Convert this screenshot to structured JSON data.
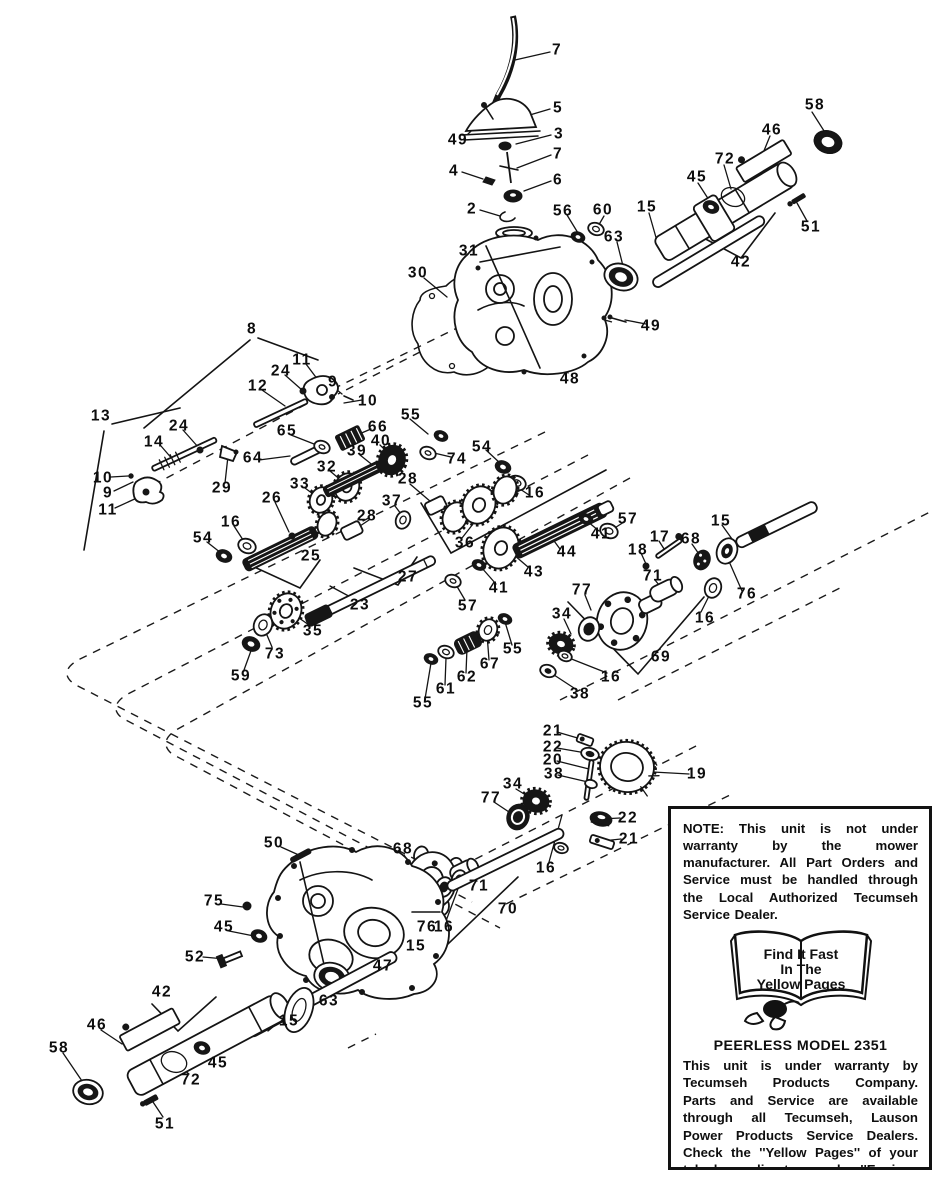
{
  "diagram": {
    "type": "exploded-parts-diagram",
    "product": "PEERLESS MODEL 2351",
    "callouts": [
      {
        "n": "7",
        "x": 557,
        "y": 50
      },
      {
        "n": "5",
        "x": 558,
        "y": 108
      },
      {
        "n": "58",
        "x": 815,
        "y": 105
      },
      {
        "n": "46",
        "x": 772,
        "y": 130
      },
      {
        "n": "3",
        "x": 559,
        "y": 134
      },
      {
        "n": "49",
        "x": 458,
        "y": 140
      },
      {
        "n": "7",
        "x": 558,
        "y": 154
      },
      {
        "n": "72",
        "x": 725,
        "y": 159
      },
      {
        "n": "4",
        "x": 454,
        "y": 171
      },
      {
        "n": "45",
        "x": 697,
        "y": 177
      },
      {
        "n": "6",
        "x": 558,
        "y": 180
      },
      {
        "n": "15",
        "x": 647,
        "y": 207
      },
      {
        "n": "2",
        "x": 472,
        "y": 209
      },
      {
        "n": "56",
        "x": 563,
        "y": 211
      },
      {
        "n": "60",
        "x": 603,
        "y": 210
      },
      {
        "n": "51",
        "x": 811,
        "y": 227
      },
      {
        "n": "63",
        "x": 614,
        "y": 237
      },
      {
        "n": "31",
        "x": 469,
        "y": 251
      },
      {
        "n": "42",
        "x": 741,
        "y": 262
      },
      {
        "n": "30",
        "x": 418,
        "y": 273
      },
      {
        "n": "49",
        "x": 651,
        "y": 326
      },
      {
        "n": "8",
        "x": 252,
        "y": 329
      },
      {
        "n": "11",
        "x": 302,
        "y": 360
      },
      {
        "n": "24",
        "x": 281,
        "y": 371
      },
      {
        "n": "9",
        "x": 333,
        "y": 382
      },
      {
        "n": "12",
        "x": 258,
        "y": 386
      },
      {
        "n": "48",
        "x": 570,
        "y": 379
      },
      {
        "n": "10",
        "x": 368,
        "y": 401
      },
      {
        "n": "13",
        "x": 101,
        "y": 416
      },
      {
        "n": "55",
        "x": 411,
        "y": 415
      },
      {
        "n": "24",
        "x": 179,
        "y": 426
      },
      {
        "n": "66",
        "x": 378,
        "y": 427
      },
      {
        "n": "65",
        "x": 287,
        "y": 431
      },
      {
        "n": "40",
        "x": 381,
        "y": 441
      },
      {
        "n": "14",
        "x": 154,
        "y": 442
      },
      {
        "n": "54",
        "x": 482,
        "y": 447
      },
      {
        "n": "39",
        "x": 357,
        "y": 451
      },
      {
        "n": "64",
        "x": 253,
        "y": 458
      },
      {
        "n": "74",
        "x": 457,
        "y": 459
      },
      {
        "n": "32",
        "x": 327,
        "y": 467
      },
      {
        "n": "10",
        "x": 103,
        "y": 478
      },
      {
        "n": "28",
        "x": 408,
        "y": 479
      },
      {
        "n": "33",
        "x": 300,
        "y": 484
      },
      {
        "n": "29",
        "x": 222,
        "y": 488
      },
      {
        "n": "9",
        "x": 108,
        "y": 493
      },
      {
        "n": "16",
        "x": 535,
        "y": 493
      },
      {
        "n": "26",
        "x": 272,
        "y": 498
      },
      {
        "n": "37",
        "x": 392,
        "y": 501
      },
      {
        "n": "11",
        "x": 108,
        "y": 510
      },
      {
        "n": "28",
        "x": 367,
        "y": 516
      },
      {
        "n": "57",
        "x": 628,
        "y": 519
      },
      {
        "n": "15",
        "x": 721,
        "y": 521
      },
      {
        "n": "16",
        "x": 231,
        "y": 522
      },
      {
        "n": "41",
        "x": 601,
        "y": 534
      },
      {
        "n": "17",
        "x": 660,
        "y": 537
      },
      {
        "n": "54",
        "x": 203,
        "y": 538
      },
      {
        "n": "68",
        "x": 691,
        "y": 539
      },
      {
        "n": "36",
        "x": 465,
        "y": 543
      },
      {
        "n": "18",
        "x": 638,
        "y": 550
      },
      {
        "n": "44",
        "x": 567,
        "y": 552
      },
      {
        "n": "25",
        "x": 311,
        "y": 556
      },
      {
        "n": "43",
        "x": 534,
        "y": 572
      },
      {
        "n": "71",
        "x": 653,
        "y": 576
      },
      {
        "n": "27",
        "x": 408,
        "y": 577
      },
      {
        "n": "41",
        "x": 499,
        "y": 588
      },
      {
        "n": "77",
        "x": 582,
        "y": 590
      },
      {
        "n": "76",
        "x": 747,
        "y": 594
      },
      {
        "n": "23",
        "x": 360,
        "y": 605
      },
      {
        "n": "57",
        "x": 468,
        "y": 606
      },
      {
        "n": "34",
        "x": 562,
        "y": 614
      },
      {
        "n": "16",
        "x": 705,
        "y": 618
      },
      {
        "n": "35",
        "x": 313,
        "y": 631
      },
      {
        "n": "55",
        "x": 513,
        "y": 649
      },
      {
        "n": "73",
        "x": 275,
        "y": 654
      },
      {
        "n": "69",
        "x": 661,
        "y": 657
      },
      {
        "n": "67",
        "x": 490,
        "y": 664
      },
      {
        "n": "59",
        "x": 241,
        "y": 676
      },
      {
        "n": "62",
        "x": 467,
        "y": 677
      },
      {
        "n": "16",
        "x": 611,
        "y": 677
      },
      {
        "n": "61",
        "x": 446,
        "y": 689
      },
      {
        "n": "38",
        "x": 580,
        "y": 694
      },
      {
        "n": "55",
        "x": 423,
        "y": 703
      },
      {
        "n": "21",
        "x": 553,
        "y": 731
      },
      {
        "n": "22",
        "x": 553,
        "y": 747
      },
      {
        "n": "20",
        "x": 553,
        "y": 760
      },
      {
        "n": "38",
        "x": 554,
        "y": 774
      },
      {
        "n": "19",
        "x": 697,
        "y": 774
      },
      {
        "n": "34",
        "x": 513,
        "y": 784
      },
      {
        "n": "77",
        "x": 491,
        "y": 798
      },
      {
        "n": "22",
        "x": 628,
        "y": 818
      },
      {
        "n": "21",
        "x": 629,
        "y": 839
      },
      {
        "n": "50",
        "x": 274,
        "y": 843
      },
      {
        "n": "68",
        "x": 403,
        "y": 849
      },
      {
        "n": "16",
        "x": 546,
        "y": 868
      },
      {
        "n": "71",
        "x": 479,
        "y": 886
      },
      {
        "n": "75",
        "x": 214,
        "y": 901
      },
      {
        "n": "70",
        "x": 508,
        "y": 909
      },
      {
        "n": "45",
        "x": 224,
        "y": 927
      },
      {
        "n": "76",
        "x": 427,
        "y": 927
      },
      {
        "n": "16",
        "x": 444,
        "y": 927
      },
      {
        "n": "15",
        "x": 416,
        "y": 946
      },
      {
        "n": "52",
        "x": 195,
        "y": 957
      },
      {
        "n": "47",
        "x": 383,
        "y": 966
      },
      {
        "n": "42",
        "x": 162,
        "y": 992
      },
      {
        "n": "63",
        "x": 329,
        "y": 1001
      },
      {
        "n": "15",
        "x": 289,
        "y": 1021
      },
      {
        "n": "46",
        "x": 97,
        "y": 1025
      },
      {
        "n": "58",
        "x": 59,
        "y": 1048
      },
      {
        "n": "45",
        "x": 218,
        "y": 1063
      },
      {
        "n": "72",
        "x": 191,
        "y": 1080
      },
      {
        "n": "51",
        "x": 165,
        "y": 1124
      }
    ]
  },
  "note_box": {
    "note": "NOTE: This unit is not under warranty by the mower manufacturer. All Part Orders and Service must be handled through the Local Authorized Tecumseh Service Dealer.",
    "badge": {
      "line1": "Find It Fast",
      "line2": "In The",
      "line3": "Yellow Pages"
    },
    "model": "PEERLESS MODEL 2351",
    "warranty": "This unit is under warranty by Tecumseh Products Company. Parts and Service are available through all Tecumseh, Lauson Power Products Service Dealers. Check the ''Yellow Pages'' of your telephone directory under ''Engines—Gasoline.''"
  }
}
